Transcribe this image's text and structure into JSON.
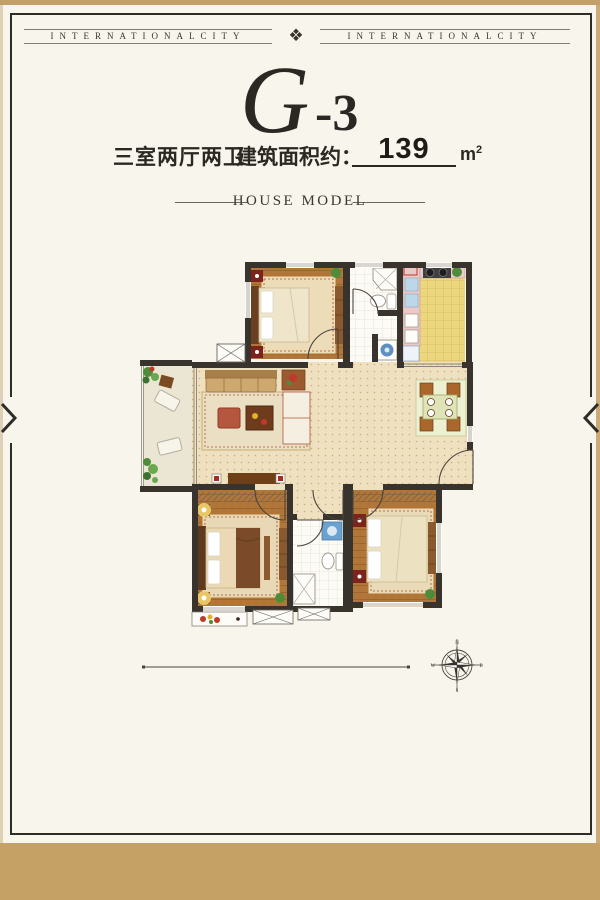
{
  "header": {
    "left_text": "INTERNATIONALCITY",
    "right_text": "INTERNATIONALCITY",
    "ornament_icon": "❖"
  },
  "title": {
    "letter": "G",
    "suffix": "-3"
  },
  "specs": {
    "layout": "三室两厅两卫",
    "area_label": "建筑面积约：",
    "area_value": "139",
    "area_unit": "m",
    "area_exponent": "2"
  },
  "section": {
    "label": "HOUSE MODEL"
  },
  "compass": {
    "north": "N",
    "east": "E",
    "south": "S",
    "west": "W"
  },
  "colors": {
    "band_tan": "#c6a166",
    "frame_dark": "#2f2b27",
    "page_bg": "#f8f5ec",
    "wall": "#39332d",
    "wood_floor": "#b0763a",
    "living_floor": "#efe1c0",
    "kitchen_tile": "#ecd77e",
    "counter_pink": "#ecc9c6",
    "accent_red": "#8e2f1f",
    "plant_green": "#4e8c3a",
    "water_blue": "#5e8fc0"
  }
}
